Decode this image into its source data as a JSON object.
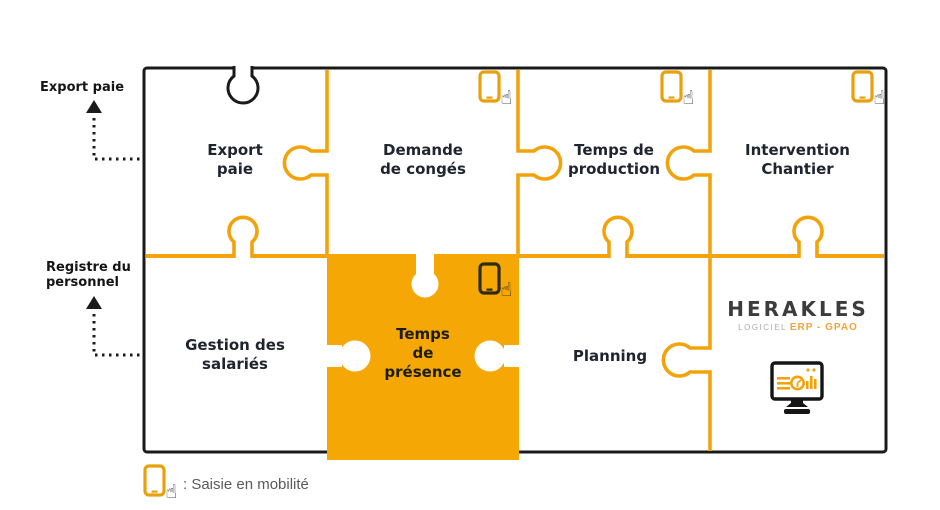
{
  "annotations": [
    {
      "label": "Export paie"
    },
    {
      "label": "Registre du\npersonnel"
    }
  ],
  "modules": [
    {
      "id": "export-paie",
      "label": "Export\npaie",
      "mobile_entry": false,
      "highlighted": false
    },
    {
      "id": "demande-de-conges",
      "label": "Demande\nde congés",
      "mobile_entry": true,
      "highlighted": false
    },
    {
      "id": "temps-de-production",
      "label": "Temps de\nproduction",
      "mobile_entry": true,
      "highlighted": false
    },
    {
      "id": "intervention-chantier",
      "label": "Intervention\nChantier",
      "mobile_entry": true,
      "highlighted": false
    },
    {
      "id": "gestion-des-salaries",
      "label": "Gestion des\nsalariés",
      "mobile_entry": false,
      "highlighted": false
    },
    {
      "id": "temps-de-presence",
      "label": "Temps\nde\nprésence",
      "mobile_entry": true,
      "highlighted": true
    },
    {
      "id": "planning",
      "label": "Planning",
      "mobile_entry": false,
      "highlighted": false
    }
  ],
  "brand": {
    "name": "HERAKLES",
    "tagline_prefix": "LOGICIEL",
    "tagline": "ERP - GPAO"
  },
  "legend": {
    "icon": "tablet-touch-icon",
    "label": ": Saisie en mobilité"
  },
  "icons": {
    "mobile_entry": "tablet-touch-icon",
    "brand_screen": "dashboard-monitor-icon"
  },
  "colors": {
    "accent_orange": "#F2A30C",
    "highlight_fill": "#F5A805",
    "box_border": "#1A1A1A",
    "piece_label": "#20242F",
    "side_label": "#151515",
    "legend_text": "#5A5A5A",
    "brand_name": "#3C3C3C",
    "brand_tagline": "#F0A43C"
  }
}
